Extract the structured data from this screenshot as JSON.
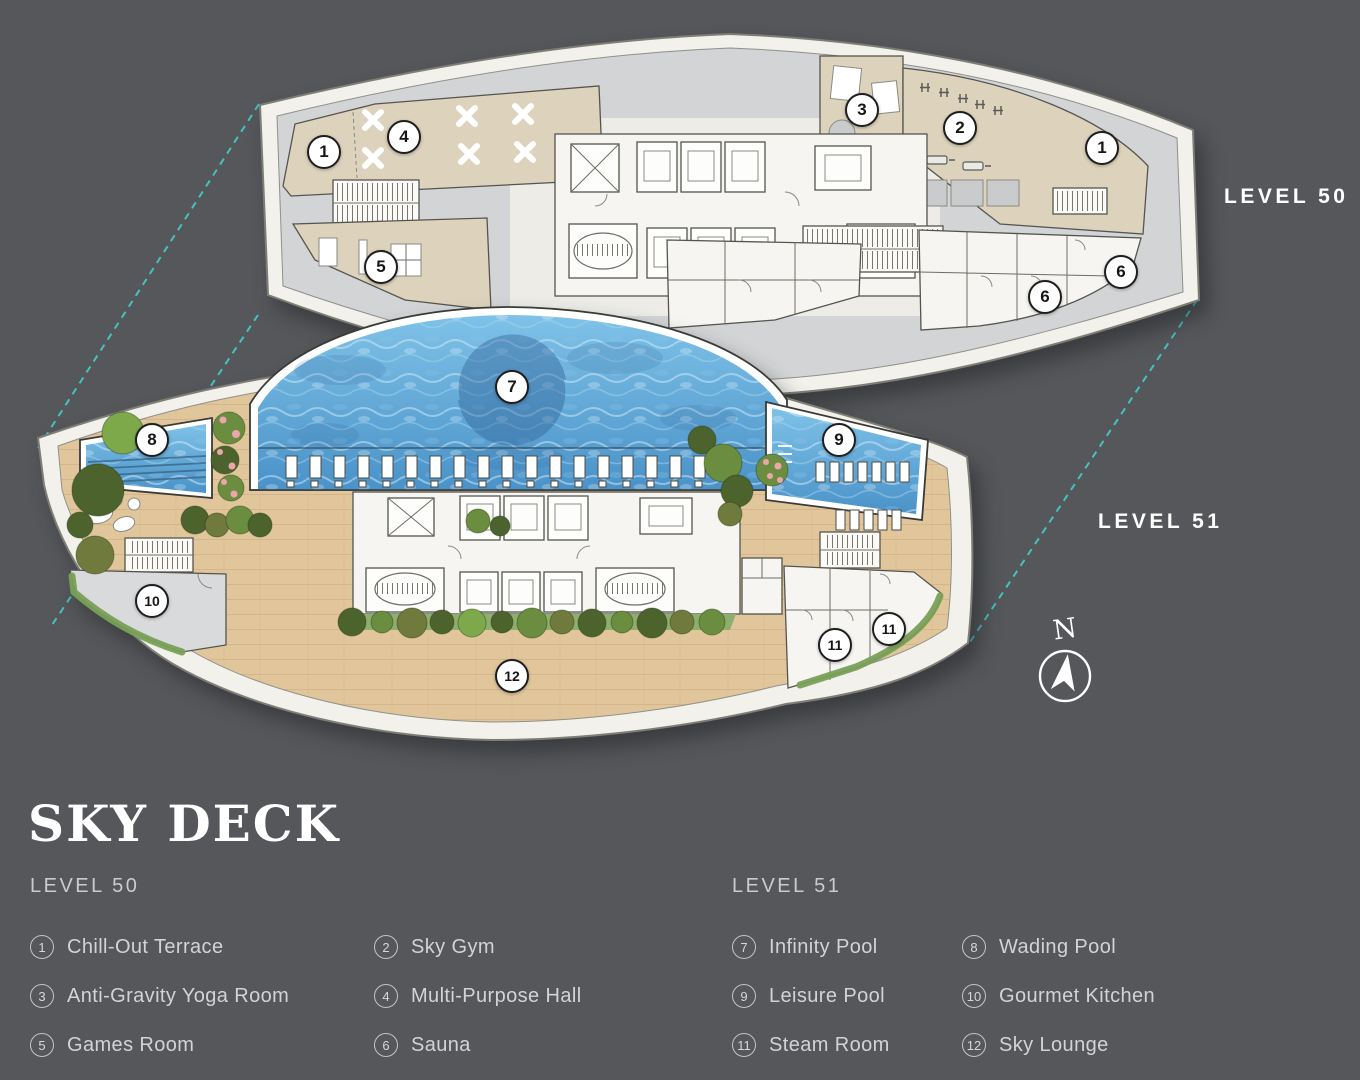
{
  "title": "SKY DECK",
  "floating_labels": {
    "level50": "LEVEL 50",
    "level51": "LEVEL 51"
  },
  "compass": {
    "north_label": "N"
  },
  "legend": {
    "level50": {
      "heading": "LEVEL 50",
      "items": [
        {
          "num": "1",
          "label": "Chill-Out Terrace"
        },
        {
          "num": "2",
          "label": "Sky Gym"
        },
        {
          "num": "3",
          "label": "Anti-Gravity Yoga Room"
        },
        {
          "num": "4",
          "label": "Multi-Purpose Hall"
        },
        {
          "num": "5",
          "label": "Games Room"
        },
        {
          "num": "6",
          "label": "Sauna"
        }
      ]
    },
    "level51": {
      "heading": "LEVEL 51",
      "items": [
        {
          "num": "7",
          "label": "Infinity Pool"
        },
        {
          "num": "8",
          "label": "Wading Pool"
        },
        {
          "num": "9",
          "label": "Leisure Pool"
        },
        {
          "num": "10",
          "label": "Gourmet Kitchen"
        },
        {
          "num": "11",
          "label": "Steam Room"
        },
        {
          "num": "12",
          "label": "Sky Lounge"
        }
      ]
    }
  },
  "plan_badges": {
    "level50": [
      {
        "num": "1",
        "x": 324,
        "y": 152
      },
      {
        "num": "4",
        "x": 404,
        "y": 137
      },
      {
        "num": "3",
        "x": 862,
        "y": 110
      },
      {
        "num": "2",
        "x": 960,
        "y": 128
      },
      {
        "num": "1",
        "x": 1102,
        "y": 148
      },
      {
        "num": "5",
        "x": 381,
        "y": 267
      },
      {
        "num": "6",
        "x": 1045,
        "y": 297
      },
      {
        "num": "6",
        "x": 1121,
        "y": 272
      }
    ],
    "level51": [
      {
        "num": "7",
        "x": 512,
        "y": 387
      },
      {
        "num": "8",
        "x": 152,
        "y": 440
      },
      {
        "num": "9",
        "x": 839,
        "y": 440
      },
      {
        "num": "10",
        "x": 152,
        "y": 601
      },
      {
        "num": "11",
        "x": 835,
        "y": 645
      },
      {
        "num": "11",
        "x": 889,
        "y": 629
      },
      {
        "num": "12",
        "x": 512,
        "y": 676
      }
    ]
  },
  "colors": {
    "background": "#55575a",
    "hull": "#f2f1ec",
    "hull_stroke": "#7e7e77",
    "floor_gray": "#d2d4d6",
    "room_beige": "#ddd3bd",
    "corridor_light": "#edece7",
    "core_white": "#f6f5f1",
    "wood": "#e1c69c",
    "wood_line": "#c8a678",
    "pool_light": "#7fc2e8",
    "pool_dark": "#4a92c8",
    "pool_deep": "#2c5e95",
    "kitchen_gray": "#d8dadc",
    "planter_green": "#79a057",
    "grass_green": "#8fae6d",
    "tree_dark": "#4c632d",
    "tree_mid": "#6b8d3f",
    "tree_light": "#7da94b",
    "tree_olive": "#6f7a3c",
    "flower_pink": "#eca6ab",
    "teal_dash": "#45c8c6",
    "text_white": "#ffffff",
    "text_muted": "#cdcfd1",
    "wall_stroke": "#55554f",
    "badge_border": "#1e1e1e"
  }
}
